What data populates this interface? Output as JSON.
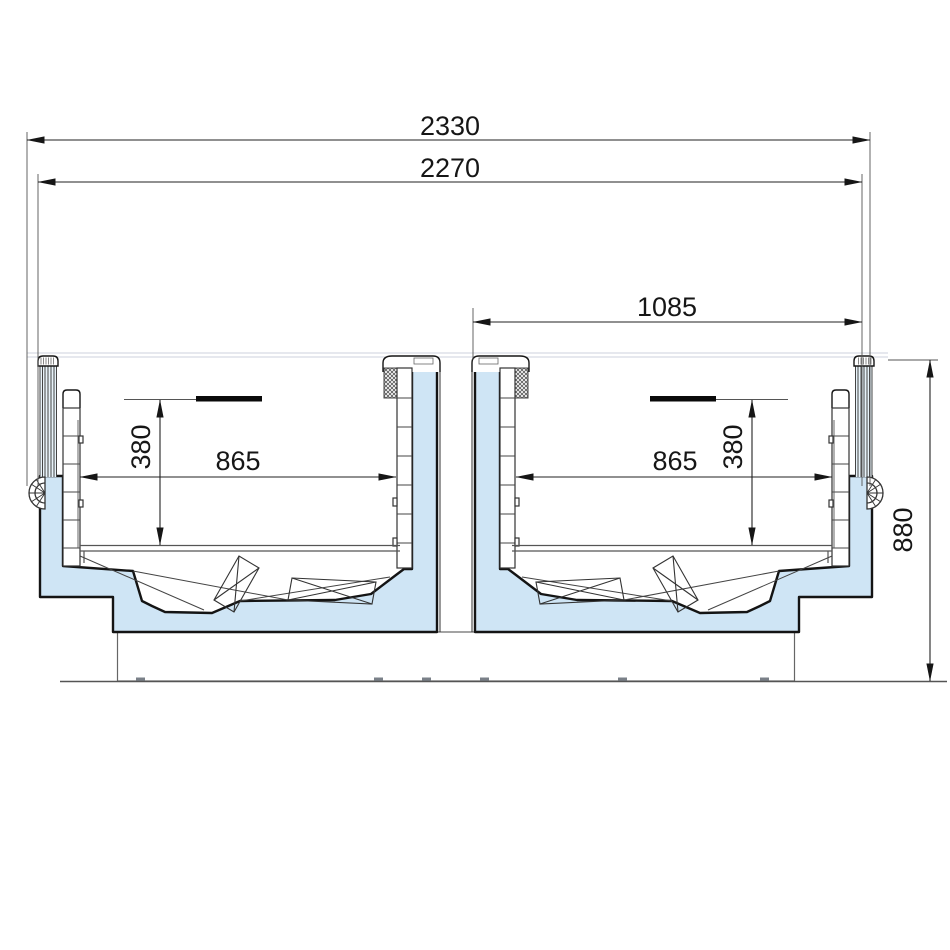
{
  "drawing": {
    "dimensions": {
      "overall_width": "2330",
      "body_width": "2270",
      "half_unit_width": "1085",
      "left_well_width": "865",
      "right_well_width": "865",
      "left_well_depth": "380",
      "right_well_depth": "380",
      "overall_height": "880"
    },
    "colors": {
      "insulation": "#cfe5f5",
      "glass": "#e8f3fa",
      "outline": "#141414"
    }
  }
}
